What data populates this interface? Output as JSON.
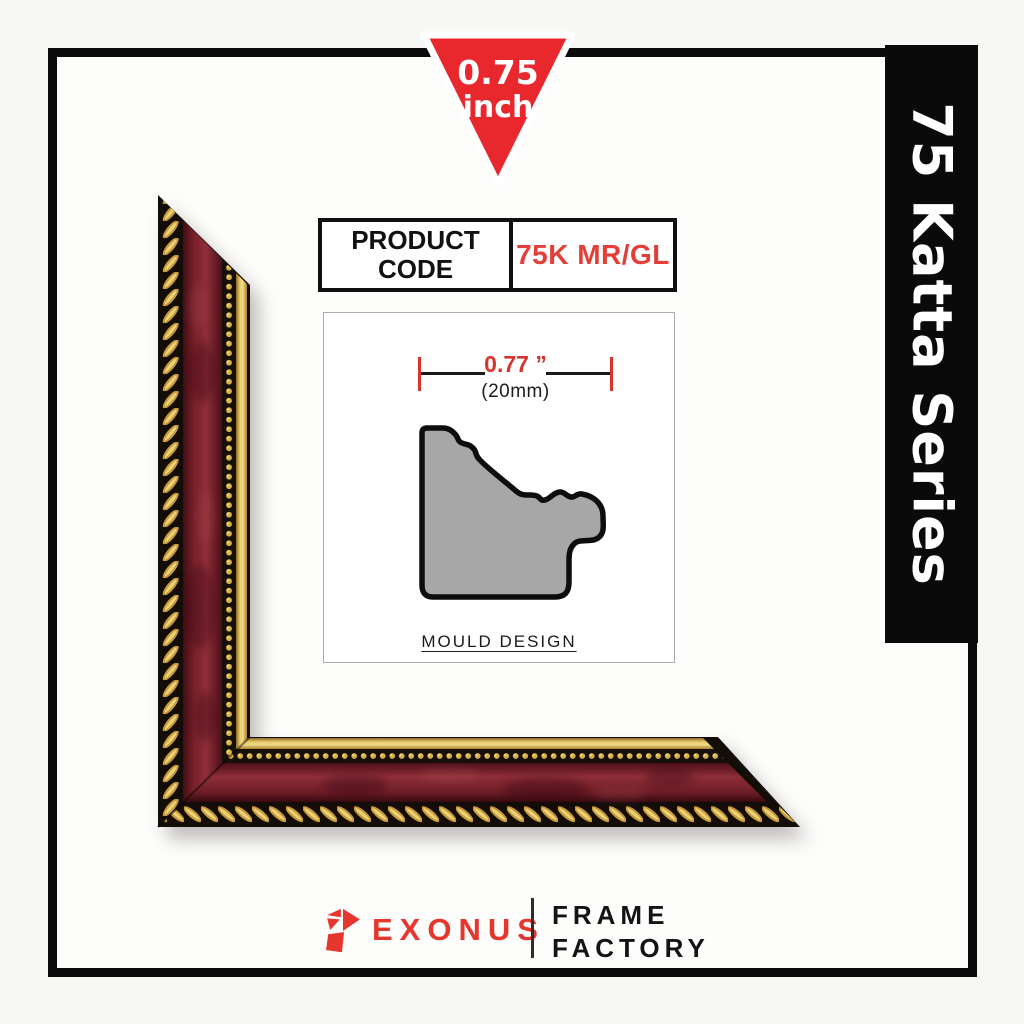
{
  "size_badge": {
    "line1": "0.75",
    "line2": "inch",
    "fill_color": "#e8282c"
  },
  "series_banner": {
    "label": "75 Katta Series",
    "bg_color": "#0a0a0a",
    "text_color": "#ffffff"
  },
  "product_code": {
    "label": "PRODUCT CODE",
    "value": "75K MR/GL",
    "value_color": "#e33e37"
  },
  "mould_design": {
    "width_inches": "0.77 ”",
    "width_mm": "(20mm)",
    "caption": "MOULD DESIGN",
    "profile_fill": "#a7a7a7",
    "dimension_color": "#d8342c"
  },
  "frame_sample": {
    "description": "Corner sample of maroon marbled moulding with gold rope outer trim, gold bead row and plain gold inner lip",
    "maroon_color": "#7a2430",
    "gold_color": "#d3a73f",
    "edge_color": "#140d07"
  },
  "brand": {
    "name": "EXONUS",
    "tagline_line1": "FRAME",
    "tagline_line2": "FACTORY",
    "accent_color": "#e6372e",
    "icon": "exonus-gem-icon"
  }
}
